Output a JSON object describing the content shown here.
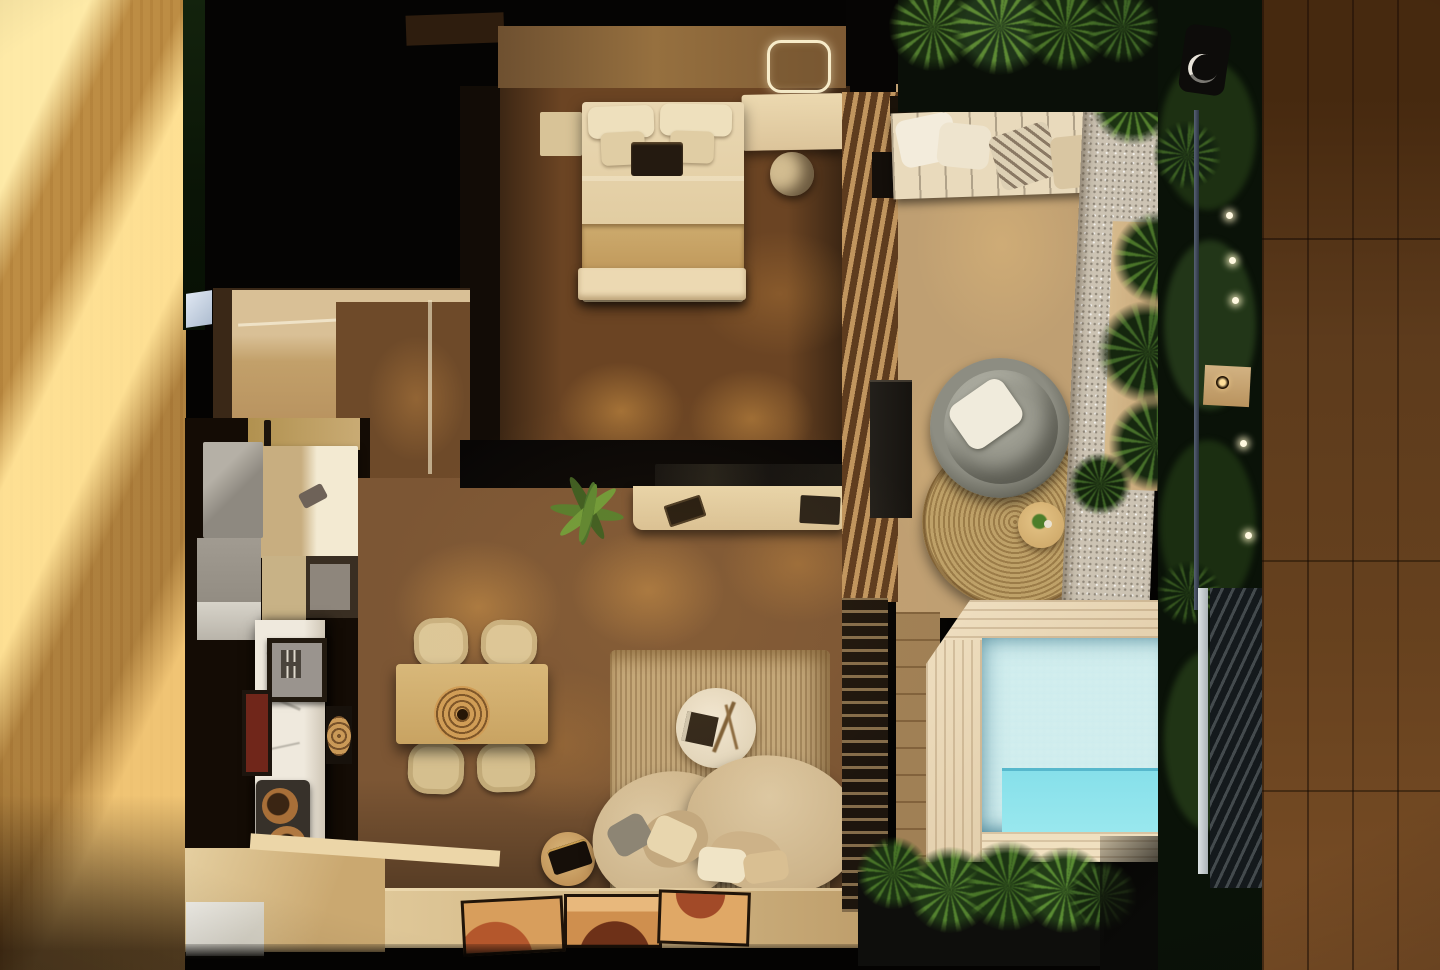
{
  "scene": {
    "title": "Night-time bird's-eye 3D render of a compact studio villa floor plan with bedroom, kitchen, living room, timber deck and plunge pool",
    "type": "photorealistic architectural visualization",
    "view": "top-down plan view",
    "lighting": "warm interior downlights, sunlight band on left wall, string lights in garden"
  },
  "palette": {
    "sunlit_wall_wood": "#f0c878",
    "sunlit_wall_shadow": "#a06f26",
    "roof_shadow": "#050403",
    "interior_floor_wood": "#7c5634",
    "floor_light_pool": "#c89858",
    "headboard_wall": "#8a6540",
    "bed_linen": "#e7d4ae",
    "blanket": "#c7a468",
    "kitchen_marble": "#ece6da",
    "cabinet_beige": "#d5c096",
    "appliance_grey": "#9b958a",
    "dining_wood": "#d0ad6e",
    "sofa_beige": "#d6c19c",
    "rug_woven": "#c2a77a",
    "deck_boards": "#bf9f72",
    "jute_rug": "#b4975f",
    "papasan_grey": "#8f8f84",
    "gravel": "#ccc3b3",
    "pool_frame_pine": "#e6d3b2",
    "pool_water": "#90d2da",
    "pool_bench_glow": "#86e0ea",
    "foliage_dark": "#16250f",
    "foliage_mid": "#3c5c22",
    "foliage_light": "#6ea03e",
    "upper_plank_wood": "#5d3b1c",
    "led_mirror_ring": "#f7ecca",
    "string_light": "#fff8e0"
  },
  "rooms": {
    "bedroom": {
      "label": "Bedroom with double bed, LED mirror, vanity desk and stool",
      "objects": [
        "headboard wall",
        "double bed with two large and two small pillows",
        "dark breakfast tray",
        "folded blanket",
        "bed-end bench",
        "nightstand",
        "LED ring mirror",
        "vanity desk",
        "round stool",
        "wardrobe in shadow"
      ]
    },
    "entry": {
      "label": "Entry hall beside kitchen",
      "objects": [
        "beige walls",
        "glowing entry door",
        "timber floor"
      ]
    },
    "kitchen": {
      "label": "Galley kitchen along left wall",
      "objects": [
        "grey appliance tower",
        "beige upper cabinets with lit counter",
        "sink with faucet",
        "open shelf",
        "marble island",
        "two-burner cooktop with pans",
        "framed artwork",
        "round rattan wall art"
      ]
    },
    "living": {
      "label": "Living room with media wall, dining set and curved sofa",
      "objects": [
        "black partition wall with TV",
        "media console with laptop",
        "potted plant",
        "dining table for four",
        "rattan centerpiece",
        "four chairs",
        "woven area rug",
        "round coffee table with book and branch decor",
        "round side table with tray",
        "kidney-shaped curved sofa with pillows",
        "platform step with three abstract artworks"
      ]
    },
    "deck": {
      "label": "Timber deck with papasan lounge chair and daybed",
      "objects": [
        "slatted facade",
        "louvre screen",
        "deck boards",
        "outdoor daybed with striped pillow",
        "black storage bench",
        "round papasan chair with grey cushion and white pillow",
        "round jute rug",
        "small round side table with plant",
        "white gravel strip",
        "timber planter with tropical plants"
      ]
    },
    "pool": {
      "label": "Plunge pool with pine surround",
      "objects": [
        "pine timber pool surround with chamfered corner",
        "aqua mosaic tiled water",
        "submerged bench",
        "poolside tropical plants in dark planter"
      ]
    },
    "surroundings": {
      "label": "Vertical garden, railing and neighbouring walkway",
      "objects": [
        "sunlit timber wall on left",
        "dark green vertical garden on right",
        "metal railing and dark fence",
        "string lights",
        "outdoor wall lamp",
        "timber bracket light",
        "dark timber upper walkway on right edge"
      ]
    }
  }
}
